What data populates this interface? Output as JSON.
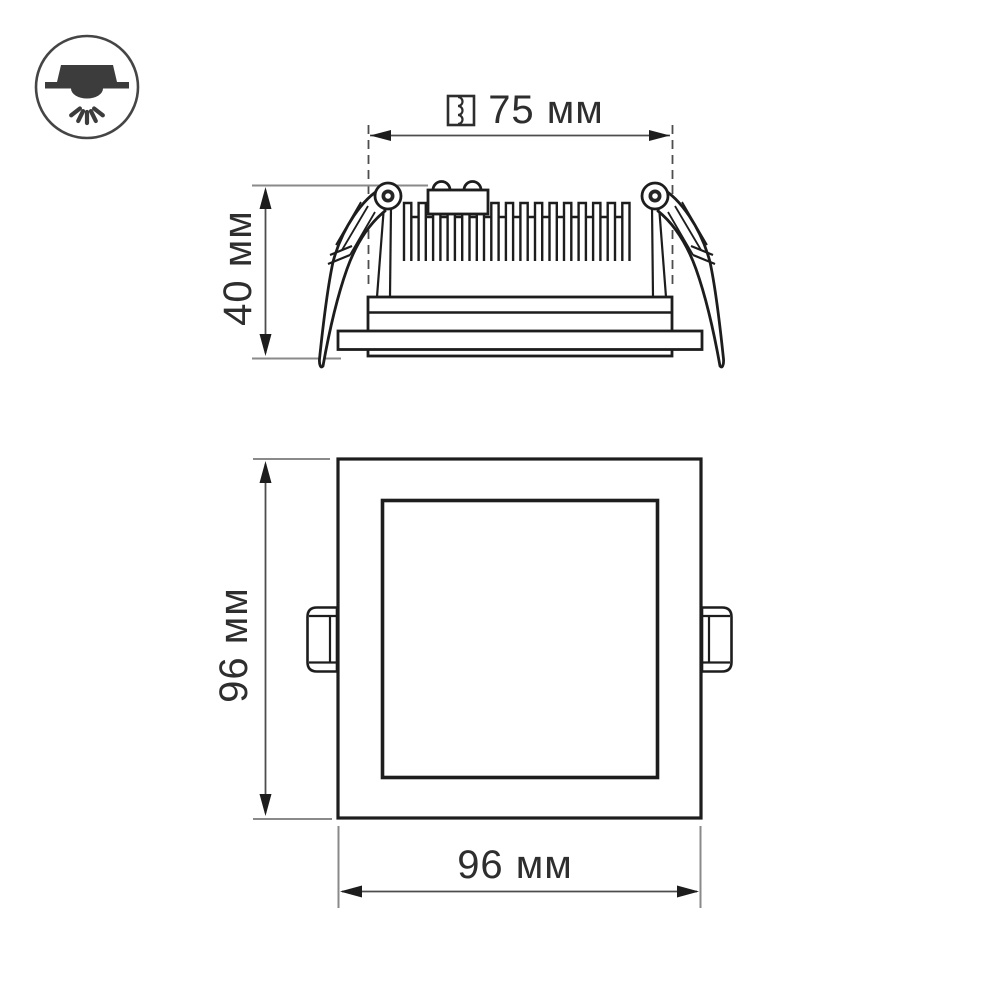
{
  "drawing": {
    "type": "dimensional technical drawing of a square recessed LED downlight",
    "views": {
      "side_view": "side profile with heatsink fins, terminal block and spring clips",
      "front_view": "square face with glass panel and two mounting tabs"
    }
  },
  "dimensions": {
    "cutout_width": {
      "value": "75 мм",
      "icon": "cutout-hole-icon",
      "orientation": "horizontal"
    },
    "fixture_height": {
      "value": "40 мм",
      "orientation": "vertical"
    },
    "panel_height": {
      "value": "96 мм",
      "orientation": "vertical"
    },
    "panel_width": {
      "value": "96 мм",
      "orientation": "horizontal"
    }
  },
  "icons": {
    "badge": "recessed-downlight-icon",
    "cutout": "cutout-hole-icon"
  },
  "colors": {
    "background": "#ffffff",
    "outline": "#1d1d1d",
    "dimension_line": "#4d4d4d",
    "extension_line": "#8a8a8a",
    "text": "#2e2e2e"
  }
}
